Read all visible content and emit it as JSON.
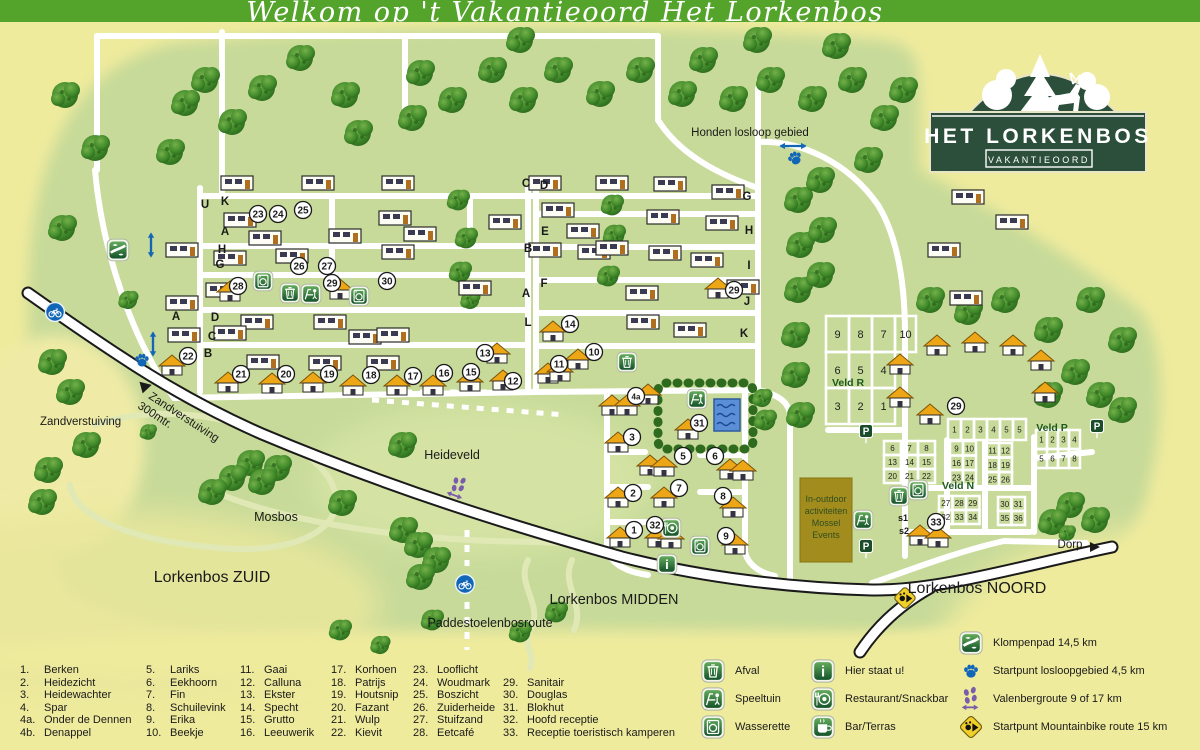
{
  "banner": {
    "text": "Welkom op 't Vakantieoord Het Lorkenbos"
  },
  "logo": {
    "title": "HET LORKENBOS",
    "subtitle": "VAKANTIEOORD"
  },
  "map": {
    "area_labels": [
      {
        "text": "Honden losloop gebied",
        "x": 750,
        "y": 136,
        "fs": 11.5
      },
      {
        "text": "Zandverstuiving",
        "x": 40,
        "y": 425,
        "fs": 11.5,
        "anchor": "start"
      },
      {
        "text": "Heideveld",
        "x": 452,
        "y": 459,
        "fs": 12.5
      },
      {
        "text": "Mosbos",
        "x": 276,
        "y": 521,
        "fs": 12.5
      },
      {
        "text": "Lorkenbos ZUID",
        "x": 212,
        "y": 582,
        "fs": 16
      },
      {
        "text": "Lorkenbos MIDDEN",
        "x": 614,
        "y": 604,
        "fs": 14.5
      },
      {
        "text": "Lorkenbos NOORD",
        "x": 977,
        "y": 593,
        "fs": 16
      },
      {
        "text": "Paddestoelenbosroute",
        "x": 490,
        "y": 627,
        "fs": 12.5
      },
      {
        "text": "Dorp",
        "x": 1070,
        "y": 548,
        "fs": 11.5
      },
      {
        "text": "Veld R",
        "x": 848,
        "y": 386,
        "fs": 10.5,
        "veld": true
      },
      {
        "text": "Veld N",
        "x": 958,
        "y": 489,
        "fs": 10.5,
        "veld": true
      },
      {
        "text": "Veld P",
        "x": 1052,
        "y": 431,
        "fs": 10.5,
        "veld": true
      }
    ],
    "rotated_label": {
      "text": "Zandverstuiving",
      "text2": "300mtr.",
      "x": 148,
      "y": 398,
      "rotate": 33
    },
    "number_markers": [
      {
        "n": "1",
        "x": 634,
        "y": 530
      },
      {
        "n": "2",
        "x": 633,
        "y": 493
      },
      {
        "n": "3",
        "x": 632,
        "y": 437
      },
      {
        "n": "4a",
        "x": 636,
        "y": 396
      },
      {
        "n": "5",
        "x": 683,
        "y": 456
      },
      {
        "n": "6",
        "x": 715,
        "y": 456
      },
      {
        "n": "7",
        "x": 679,
        "y": 488
      },
      {
        "n": "8",
        "x": 723,
        "y": 496
      },
      {
        "n": "9",
        "x": 726,
        "y": 536
      },
      {
        "n": "10",
        "x": 594,
        "y": 352
      },
      {
        "n": "11",
        "x": 559,
        "y": 364
      },
      {
        "n": "12",
        "x": 513,
        "y": 381
      },
      {
        "n": "13",
        "x": 485,
        "y": 353
      },
      {
        "n": "14",
        "x": 570,
        "y": 324
      },
      {
        "n": "15",
        "x": 471,
        "y": 372
      },
      {
        "n": "16",
        "x": 444,
        "y": 373
      },
      {
        "n": "17",
        "x": 413,
        "y": 376
      },
      {
        "n": "18",
        "x": 371,
        "y": 375
      },
      {
        "n": "19",
        "x": 329,
        "y": 374
      },
      {
        "n": "20",
        "x": 286,
        "y": 374
      },
      {
        "n": "21",
        "x": 241,
        "y": 374
      },
      {
        "n": "22",
        "x": 188,
        "y": 356
      },
      {
        "n": "23",
        "x": 258,
        "y": 214
      },
      {
        "n": "24",
        "x": 278,
        "y": 214
      },
      {
        "n": "25",
        "x": 303,
        "y": 210
      },
      {
        "n": "26",
        "x": 299,
        "y": 266
      },
      {
        "n": "27",
        "x": 327,
        "y": 266
      },
      {
        "n": "28",
        "x": 238,
        "y": 286
      },
      {
        "n": "29",
        "x": 332,
        "y": 283
      },
      {
        "n": "30",
        "x": 387,
        "y": 281
      },
      {
        "n": "29",
        "x": 734,
        "y": 290
      },
      {
        "n": "29",
        "x": 956,
        "y": 406
      },
      {
        "n": "31",
        "x": 699,
        "y": 423
      },
      {
        "n": "32",
        "x": 655,
        "y": 525
      },
      {
        "n": "33",
        "x": 936,
        "y": 522
      }
    ],
    "letter_markers": [
      {
        "l": "U",
        "x": 205,
        "y": 208
      },
      {
        "l": "K",
        "x": 225,
        "y": 205
      },
      {
        "l": "A",
        "x": 225,
        "y": 235
      },
      {
        "l": "H",
        "x": 222,
        "y": 253
      },
      {
        "l": "G",
        "x": 220,
        "y": 268
      },
      {
        "l": "D",
        "x": 215,
        "y": 321
      },
      {
        "l": "C",
        "x": 212,
        "y": 340
      },
      {
        "l": "B",
        "x": 208,
        "y": 357
      },
      {
        "l": "A",
        "x": 176,
        "y": 320
      },
      {
        "l": "C",
        "x": 526,
        "y": 187
      },
      {
        "l": "B",
        "x": 528,
        "y": 252
      },
      {
        "l": "A",
        "x": 526,
        "y": 297
      },
      {
        "l": "L",
        "x": 528,
        "y": 326
      },
      {
        "l": "D",
        "x": 544,
        "y": 189
      },
      {
        "l": "E",
        "x": 545,
        "y": 235
      },
      {
        "l": "F",
        "x": 544,
        "y": 287
      },
      {
        "l": "G",
        "x": 747,
        "y": 200
      },
      {
        "l": "H",
        "x": 749,
        "y": 234
      },
      {
        "l": "I",
        "x": 749,
        "y": 269
      },
      {
        "l": "J",
        "x": 747,
        "y": 305
      },
      {
        "l": "K",
        "x": 744,
        "y": 337
      },
      {
        "l": "s1",
        "x": 903,
        "y": 521
      },
      {
        "l": "s2",
        "x": 904,
        "y": 534
      }
    ],
    "plot_grids": [
      {
        "x": 826,
        "y": 316,
        "cw": 23,
        "ch": 36,
        "cols": 3,
        "fs": 11,
        "nums": [
          "9",
          "8",
          "7",
          "6",
          "5",
          "4",
          "3",
          "2",
          "1"
        ]
      },
      {
        "x": 895,
        "y": 316,
        "cw": 21,
        "ch": 36,
        "cols": 1,
        "fs": 11,
        "nums": [
          "10"
        ]
      },
      {
        "x": 948,
        "y": 419,
        "cw": 13,
        "ch": 21,
        "cols": 6,
        "fs": 8,
        "nums": [
          "1",
          "2",
          "3",
          "4",
          "5",
          "5"
        ]
      },
      {
        "x": 884,
        "y": 441,
        "cw": 17,
        "ch": 14,
        "cols": 3,
        "fs": 8,
        "nums": [
          "6",
          "7",
          "8",
          "13",
          "14",
          "15",
          "20",
          "21",
          "22"
        ]
      },
      {
        "x": 950,
        "y": 441,
        "cw": 13,
        "ch": 14.5,
        "cols": 2,
        "fs": 8,
        "nums": [
          "9",
          "10",
          "16",
          "17",
          "23",
          "24"
        ]
      },
      {
        "x": 986,
        "y": 443,
        "cw": 13,
        "ch": 14.5,
        "cols": 2,
        "fs": 8,
        "nums": [
          "11",
          "12",
          "18",
          "19",
          "25",
          "26"
        ]
      },
      {
        "x": 939,
        "y": 496,
        "cw": 13.5,
        "ch": 14,
        "cols": 3,
        "fs": 8,
        "nums": [
          "27",
          "28",
          "29",
          "32",
          "33",
          "34"
        ]
      },
      {
        "x": 998,
        "y": 497,
        "cw": 13.5,
        "ch": 14,
        "cols": 2,
        "fs": 8,
        "nums": [
          "30",
          "31",
          "35",
          "36"
        ]
      },
      {
        "x": 1036,
        "y": 430,
        "cw": 11,
        "ch": 19,
        "cols": 4,
        "fs": 8,
        "nums": [
          "1",
          "2",
          "3",
          "4",
          "5",
          "6",
          "7",
          "8"
        ]
      }
    ],
    "facility_icons": [
      {
        "t": "laundry",
        "x": 263,
        "y": 281
      },
      {
        "t": "trash",
        "x": 290,
        "y": 293
      },
      {
        "t": "playground",
        "x": 311,
        "y": 294
      },
      {
        "t": "laundry",
        "x": 359,
        "y": 296
      },
      {
        "t": "playground",
        "x": 697,
        "y": 399
      },
      {
        "t": "restaurant",
        "x": 671,
        "y": 528
      },
      {
        "t": "laundry",
        "x": 700,
        "y": 546
      },
      {
        "t": "info",
        "x": 667,
        "y": 564
      },
      {
        "t": "trash",
        "x": 627,
        "y": 362
      },
      {
        "t": "trash",
        "x": 899,
        "y": 496
      },
      {
        "t": "laundry",
        "x": 918,
        "y": 490
      },
      {
        "t": "playground",
        "x": 863,
        "y": 520
      },
      {
        "t": "p",
        "x": 866,
        "y": 431
      },
      {
        "t": "p",
        "x": 866,
        "y": 546
      },
      {
        "t": "p",
        "x": 1097,
        "y": 426
      }
    ],
    "route_icons": [
      {
        "t": "bike",
        "x": 55,
        "y": 312
      },
      {
        "t": "bike",
        "x": 465,
        "y": 584
      },
      {
        "t": "paw",
        "x": 142,
        "y": 360
      },
      {
        "t": "varrow",
        "x": 153,
        "y": 344
      },
      {
        "t": "klomp",
        "x": 118,
        "y": 250
      },
      {
        "t": "varrow",
        "x": 151,
        "y": 245
      },
      {
        "t": "paw",
        "x": 795,
        "y": 158,
        "r": -25
      },
      {
        "t": "harrow",
        "x": 793,
        "y": 146
      },
      {
        "t": "footprints",
        "x": 458,
        "y": 488,
        "r": 20
      },
      {
        "t": "mtb",
        "x": 905,
        "y": 598
      }
    ],
    "activity_box": {
      "lines": [
        "In-outdoor",
        "activiteiten",
        "Mossel",
        "Events"
      ]
    }
  },
  "legend": {
    "columns": [
      [
        [
          "1.",
          "Berken"
        ],
        [
          "2.",
          "Heidezicht"
        ],
        [
          "3.",
          "Heidewachter"
        ],
        [
          "4.",
          "Spar"
        ],
        [
          "4a.",
          "Onder de Dennen"
        ],
        [
          "4b.",
          "Denappel"
        ]
      ],
      [
        [
          "5.",
          "Lariks"
        ],
        [
          "6.",
          "Eekhoorn"
        ],
        [
          "7.",
          "Fin"
        ],
        [
          "8.",
          "Schuilevink"
        ],
        [
          "9.",
          "Erika"
        ],
        [
          "10.",
          "Beekje"
        ]
      ],
      [
        [
          "11.",
          "Gaai"
        ],
        [
          "12.",
          "Calluna"
        ],
        [
          "13.",
          "Ekster"
        ],
        [
          "14.",
          "Specht"
        ],
        [
          "15.",
          "Grutto"
        ],
        [
          "16.",
          "Leeuwerik"
        ]
      ],
      [
        [
          "17.",
          "Korhoen"
        ],
        [
          "18.",
          "Patrijs"
        ],
        [
          "19.",
          "Houtsnip"
        ],
        [
          "20.",
          "Fazant"
        ],
        [
          "21.",
          "Wulp"
        ],
        [
          "22.",
          "Kievit"
        ]
      ],
      [
        [
          "23.",
          "Looflicht"
        ],
        [
          "24.",
          "Woudmark"
        ],
        [
          "25.",
          "Boszicht"
        ],
        [
          "26.",
          "Zuiderheide"
        ],
        [
          "27.",
          "Stuifzand"
        ],
        [
          "28.",
          "Eetcafé"
        ]
      ],
      [
        [
          "29.",
          "Sanitair"
        ],
        [
          "30.",
          "Douglas"
        ],
        [
          "31.",
          "Blokhut"
        ],
        [
          "32.",
          "Hoofd receptie"
        ],
        [
          "33.",
          "Receptie toeristisch kamperen"
        ]
      ]
    ],
    "facilities": [
      {
        "icon": "trash",
        "label": "Afval"
      },
      {
        "icon": "playground",
        "label": "Speeltuin"
      },
      {
        "icon": "laundry",
        "label": "Wasserette"
      }
    ],
    "facilities2": [
      {
        "icon": "info",
        "label": "Hier staat u!"
      },
      {
        "icon": "restaurant",
        "label": "Restaurant/Snackbar"
      },
      {
        "icon": "bar",
        "label": "Bar/Terras"
      }
    ],
    "routes": [
      {
        "icon": "klomp",
        "label": "Klompenpad 14,5 km"
      },
      {
        "icon": "paw",
        "label": "Startpunt losloopgebied 4,5 km"
      },
      {
        "icon": "footprints",
        "label": "Valenbergroute 9 of 17 km"
      },
      {
        "icon": "mtb",
        "label": "Startpunt Mountainbike route 15 km"
      }
    ]
  },
  "colors": {
    "banner_green": "#54a32b",
    "map_green": "#c7da99",
    "bg_yellow": "#efeb9d",
    "logo_green": "#2c4f3c",
    "road_white": "#ffffff",
    "route_blue": "#1266b8",
    "route_purple": "#7b5caa",
    "mtb_yellow": "#f0cf2a",
    "activity_brown": "#a38c1e"
  }
}
